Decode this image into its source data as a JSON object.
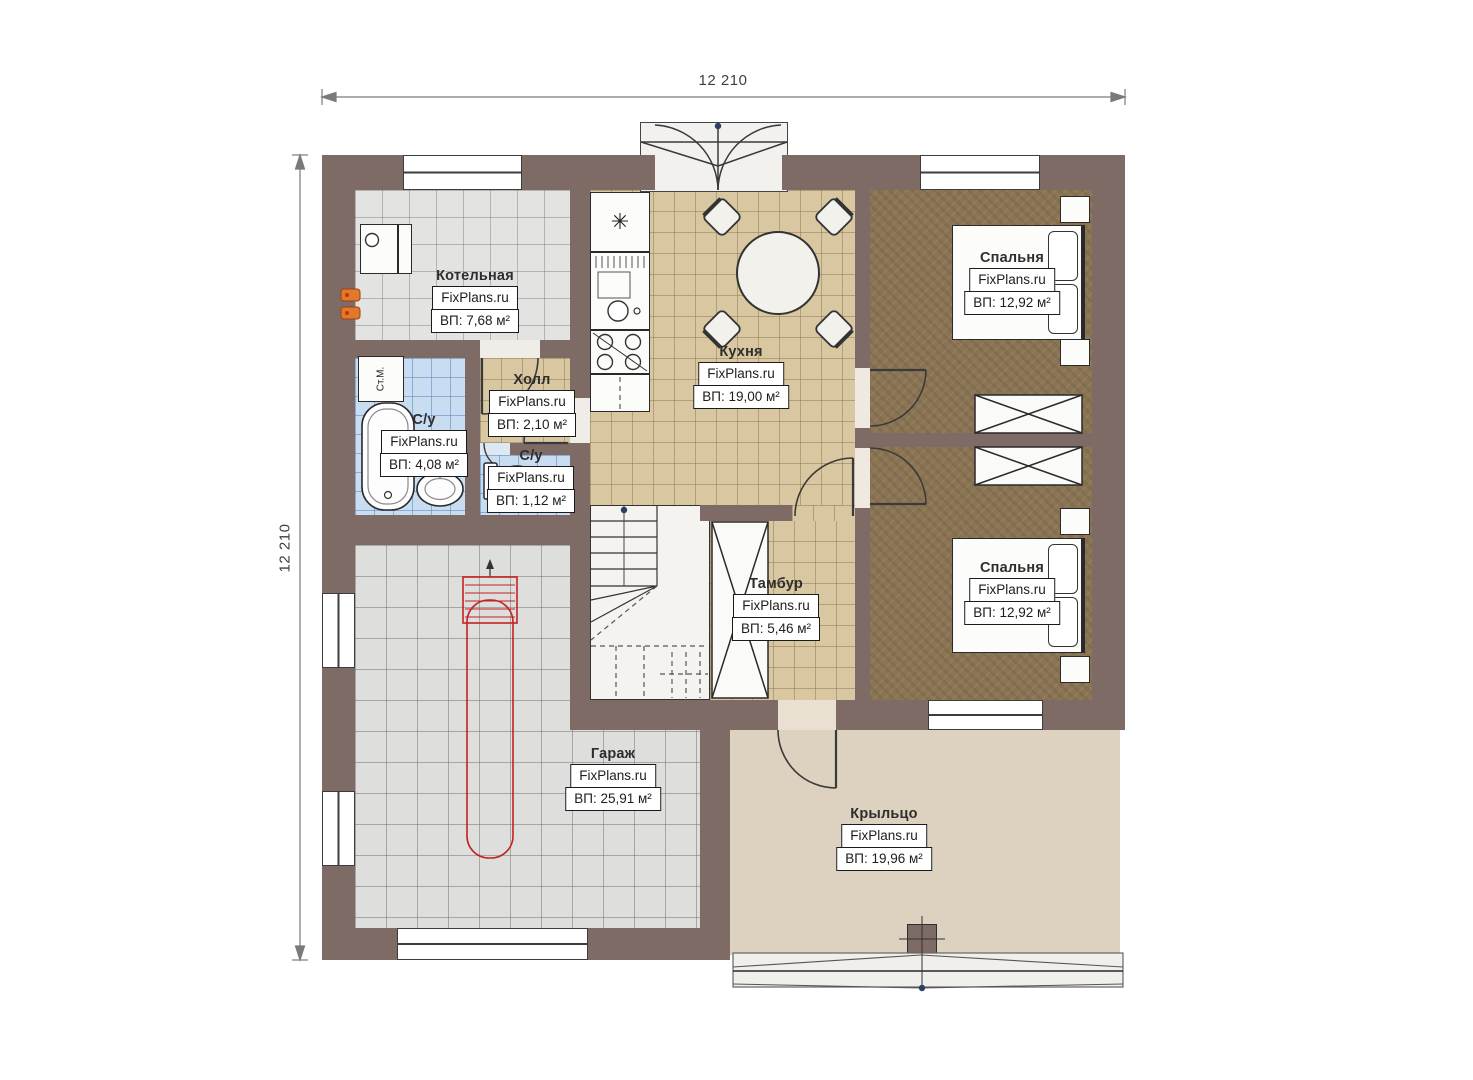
{
  "dimensions": {
    "top": "12 210",
    "left": "12 210"
  },
  "rooms": [
    {
      "id": "kotelnaya",
      "name": "Котельная",
      "brand": "FixPlans.ru",
      "area": "ВП: 7,68 м²"
    },
    {
      "id": "holl",
      "name": "Холл",
      "brand": "FixPlans.ru",
      "area": "ВП: 2,10 м²"
    },
    {
      "id": "su-big",
      "name": "С/у",
      "brand": "FixPlans.ru",
      "area": "ВП: 4,08 м²"
    },
    {
      "id": "su-small",
      "name": "С/у",
      "brand": "FixPlans.ru",
      "area": "ВП: 1,12 м²"
    },
    {
      "id": "kuhnya",
      "name": "Кухня",
      "brand": "FixPlans.ru",
      "area": "ВП: 19,00 м²"
    },
    {
      "id": "spalnya-1",
      "name": "Спальня",
      "brand": "FixPlans.ru",
      "area": "ВП: 12,92 м²"
    },
    {
      "id": "spalnya-2",
      "name": "Спальня",
      "brand": "FixPlans.ru",
      "area": "ВП: 12,92 м²"
    },
    {
      "id": "tambur",
      "name": "Тамбур",
      "brand": "FixPlans.ru",
      "area": "ВП: 5,46 м²"
    },
    {
      "id": "garazh",
      "name": "Гараж",
      "brand": "FixPlans.ru",
      "area": "ВП: 25,91 м²"
    },
    {
      "id": "krylco",
      "name": "Крыльцо",
      "brand": "FixPlans.ru",
      "area": "ВП: 19,96 м²"
    }
  ],
  "furniture": {
    "washing_machine": "Ст.М."
  },
  "icons": {
    "fridge_snowflake": "✳"
  },
  "colors": {
    "wall": "#7e6b66",
    "kitchen_floor": "#d8c7a0",
    "bath_floor": "#c8dcf2",
    "utility_floor": "#e3e3e2",
    "bedroom_floor": "#8b7454",
    "porch_floor": "#ddd1c0",
    "car_outline": "#c22222",
    "radiator": "#e07a28",
    "marker_dot": "#2d3e63"
  }
}
